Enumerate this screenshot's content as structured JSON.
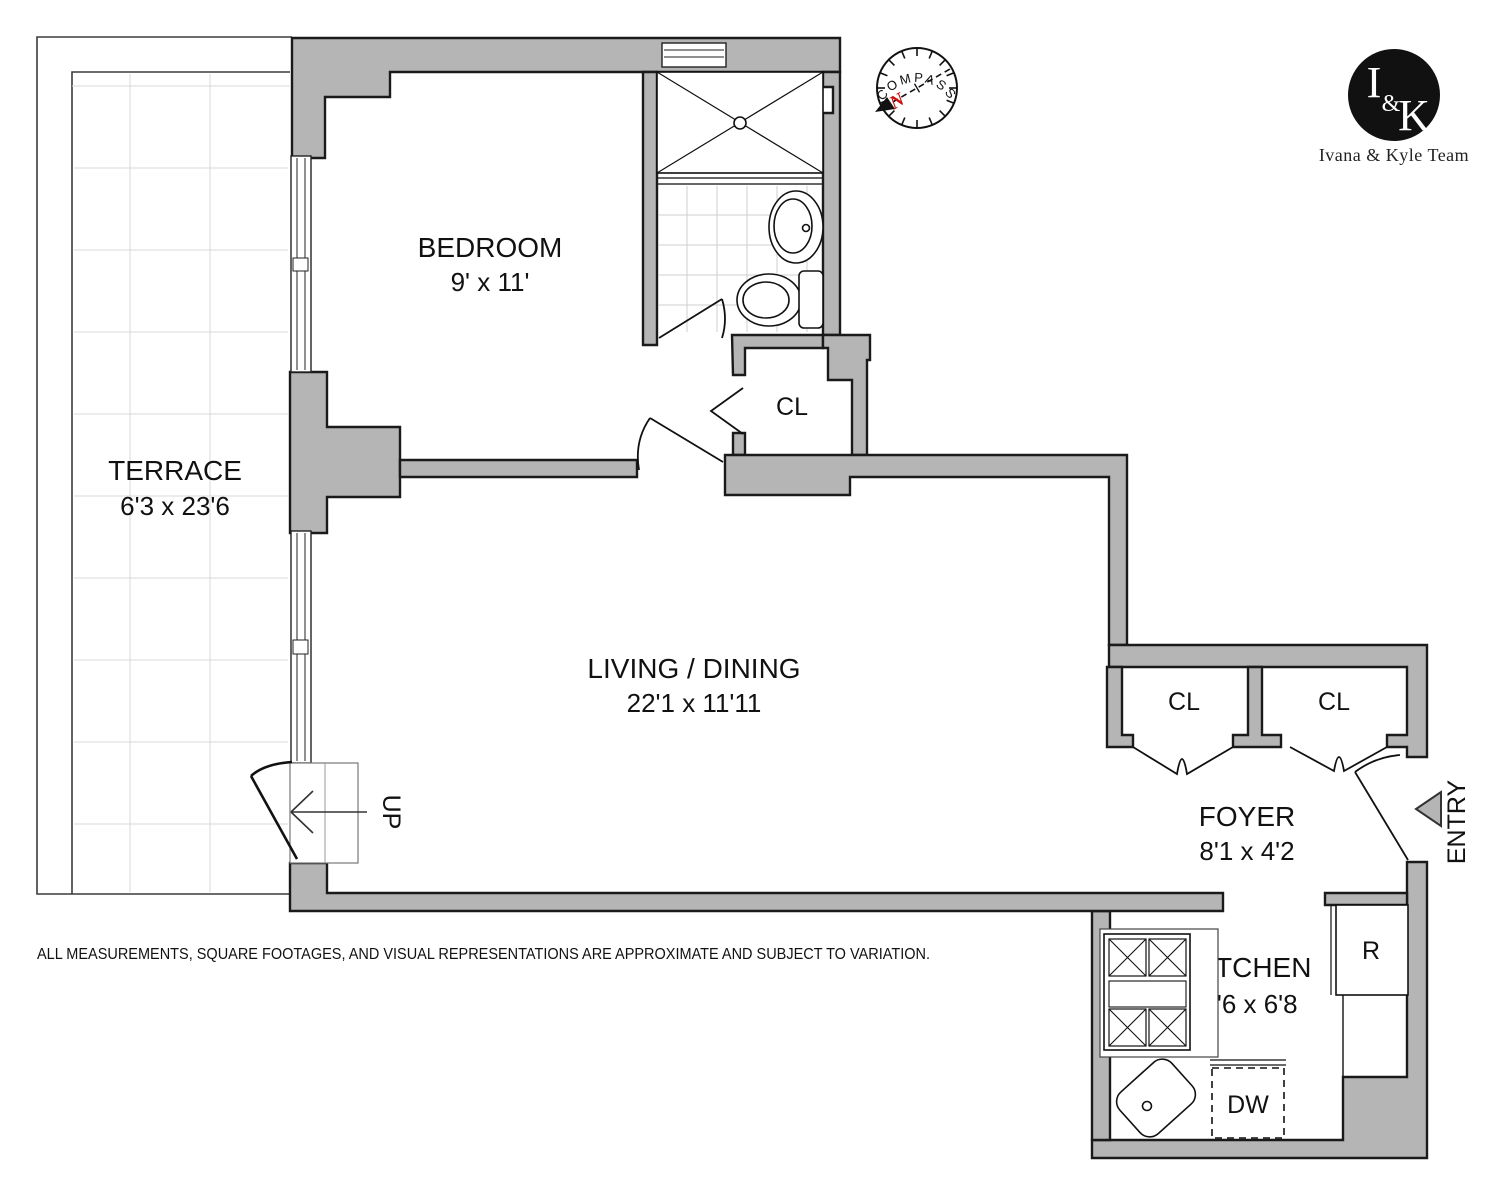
{
  "plan": {
    "rooms": {
      "terrace": {
        "name": "TERRACE",
        "dims": "6'3 x 23'6"
      },
      "bedroom": {
        "name": "BEDROOM",
        "dims": "9' x 11'"
      },
      "living": {
        "name": "LIVING / DINING",
        "dims": "22'1 x 11'11"
      },
      "foyer": {
        "name": "FOYER",
        "dims": "8'1 x 4'2"
      },
      "kitchen": {
        "name": "KITCHEN",
        "dims": "8'6 x 6'8"
      }
    },
    "closets": {
      "bedroom_closet": "CL",
      "foyer_closet_left": "CL",
      "foyer_closet_right": "CL"
    },
    "appliances": {
      "refrigerator": "R",
      "dishwasher": "DW"
    },
    "annotations": {
      "entry": "ENTRY",
      "up": "UP"
    }
  },
  "compass": {
    "label": "COMPASS",
    "north": "N"
  },
  "branding": {
    "monogram_i": "I",
    "monogram_amp": "&",
    "monogram_k": "K",
    "team": "Ivana & Kyle Team"
  },
  "disclaimer": "ALL MEASUREMENTS, SQUARE FOOTAGES, AND VISUAL REPRESENTATIONS ARE APPROXIMATE AND SUBJECT TO VARIATION.",
  "colors": {
    "wall": "#b5b5b5",
    "line": "#111111",
    "north_red": "#cc1111",
    "tile_grid": "#d9d9d9"
  }
}
